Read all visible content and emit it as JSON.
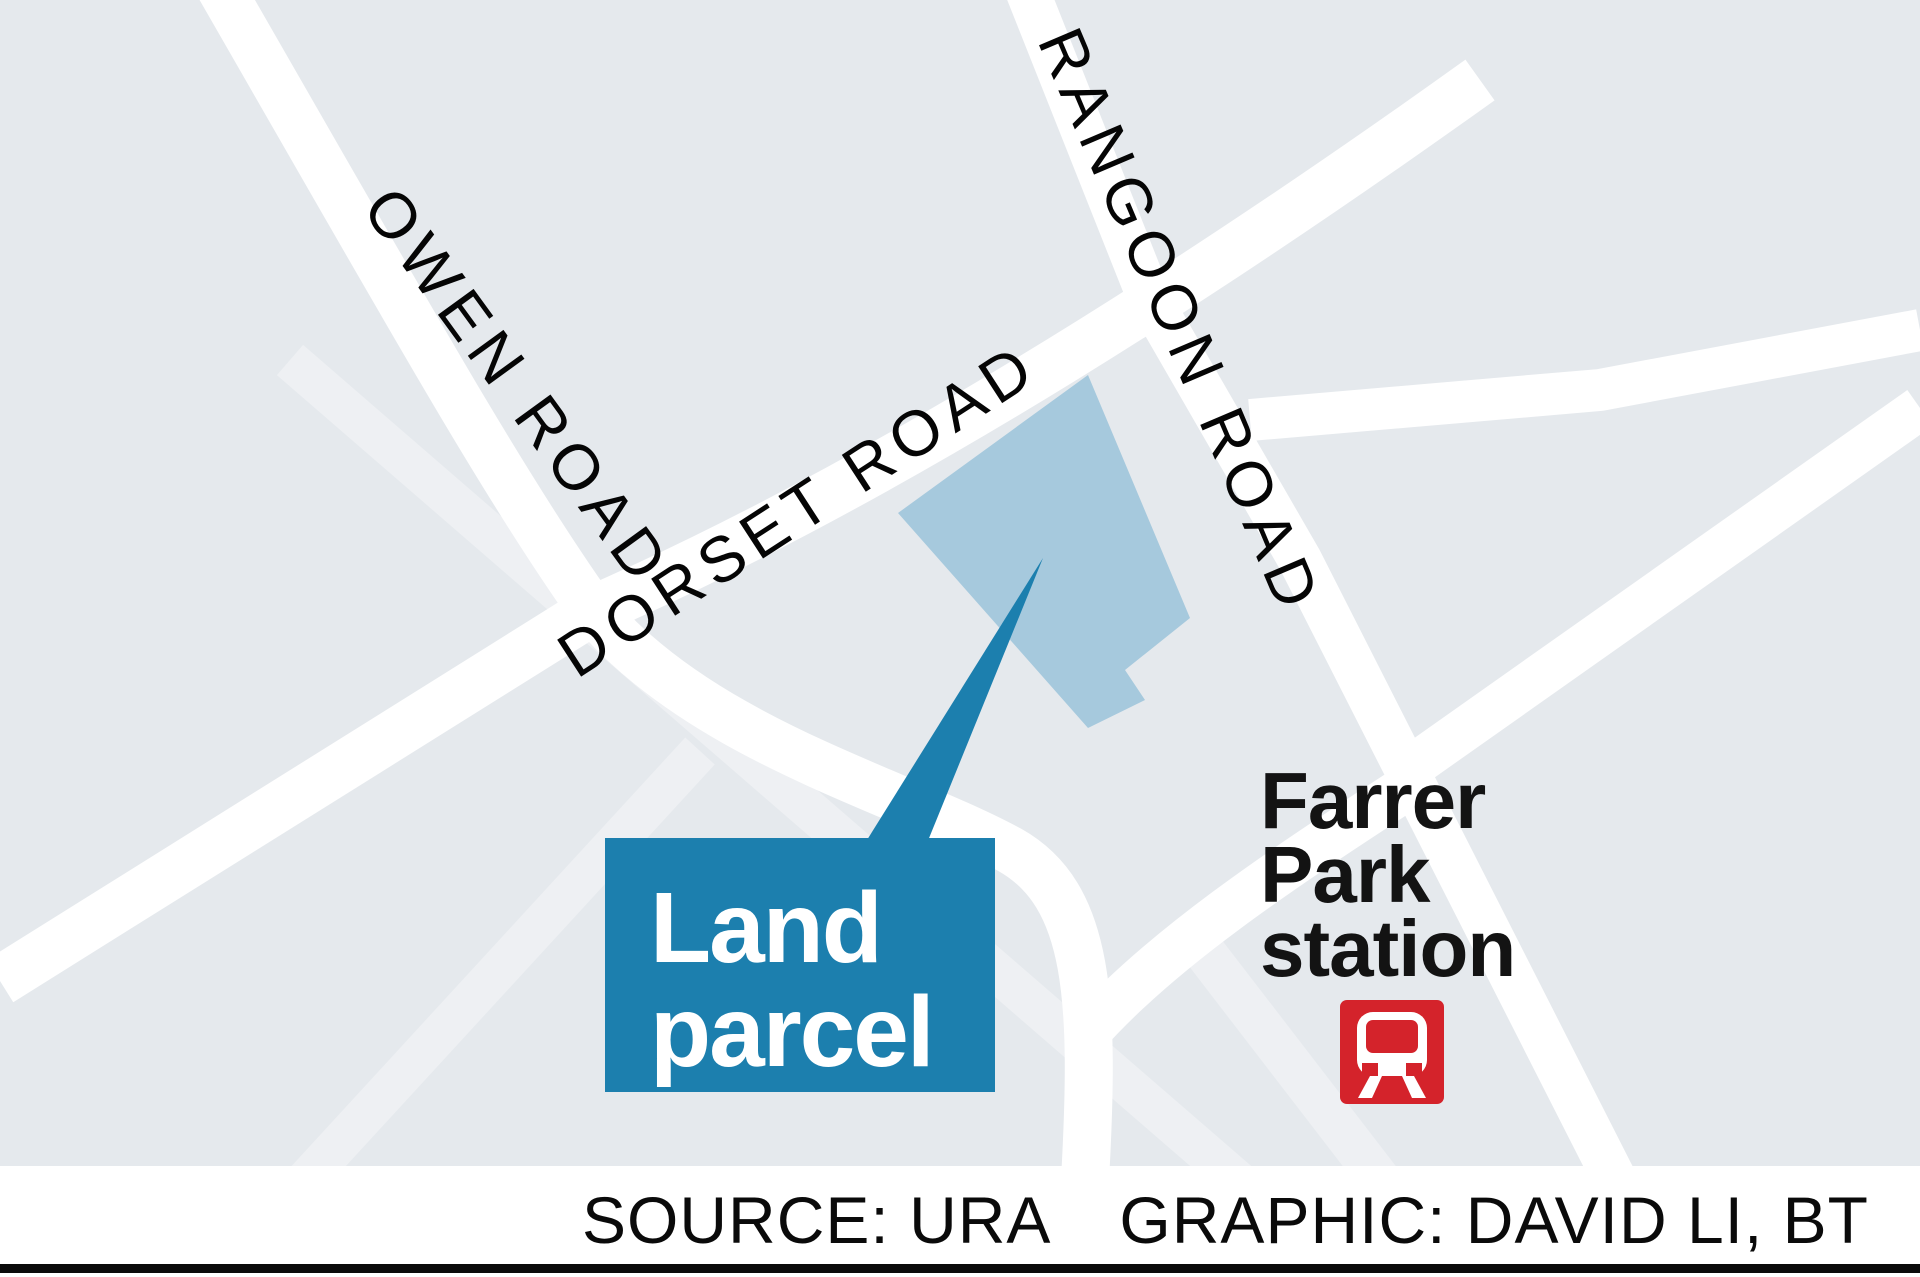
{
  "map": {
    "background_color": "#e5e9ed",
    "road_color": "#ffffff",
    "minor_road_color": "#eef0f3",
    "parcel_fill": "#a6c9dd",
    "accent_blue": "#1c7fae",
    "station_red": "#d4232b",
    "road_labels": [
      {
        "name": "owen-road",
        "text": "OWEN ROAD"
      },
      {
        "name": "dorset-road",
        "text": "DORSET ROAD"
      },
      {
        "name": "rangoon-road",
        "text": "RANGOON ROAD"
      }
    ],
    "callout": {
      "line1": "Land",
      "line2": "parcel"
    },
    "station": {
      "line1": "Farrer",
      "line2": "Park",
      "line3": "station",
      "icon": "mrt-train-icon"
    }
  },
  "footer": {
    "source": "SOURCE: URA",
    "credit": "GRAPHIC: DAVID LI, BT"
  }
}
